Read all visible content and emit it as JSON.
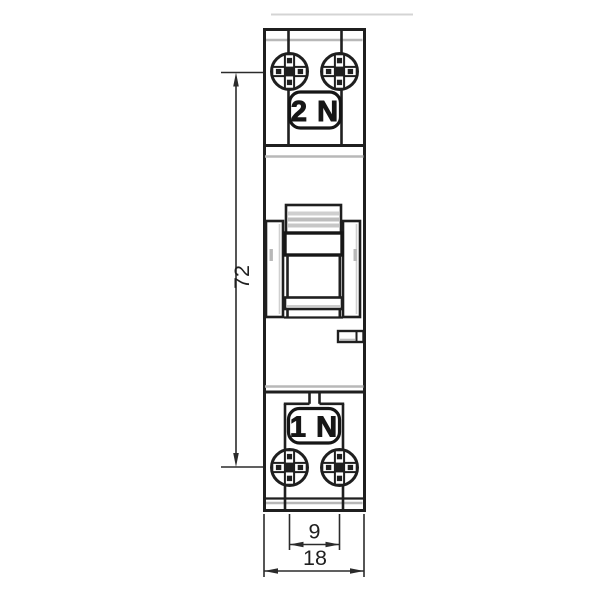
{
  "terminal_labels": {
    "top": "2 N",
    "bottom": "1 N"
  },
  "dimensions": {
    "height": "72",
    "terminal_spacing": "9",
    "width": "18"
  },
  "colors": {
    "line": "#1f1f1f",
    "dimension_line": "#2b2b2b",
    "shading_gray": "#b8b8b8",
    "light_gray": "#d4d4d4",
    "background": "#ffffff"
  },
  "icons": {
    "screw_head": "combination-pozidriv-screw-head"
  }
}
